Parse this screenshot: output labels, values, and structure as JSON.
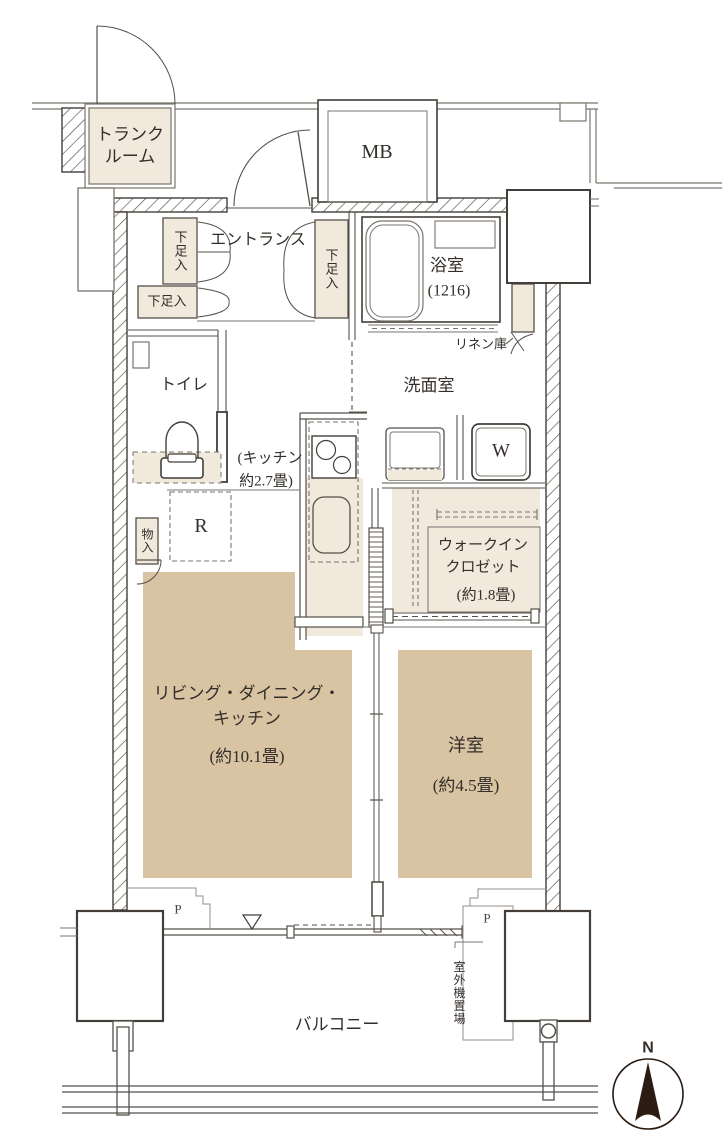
{
  "meta": {
    "width": 722,
    "height": 1140,
    "kind": "apartment-floor-plan"
  },
  "colors": {
    "room_fill_light": "#f2e9dd",
    "room_fill_tan": "#d8c3a2",
    "wall_dark": "#433e39",
    "line_mid": "#7a746e",
    "text": "#332e2a",
    "compass": "#2a1c13"
  },
  "labels": {
    "trunk_room": "トランク\nルーム",
    "meter_box": "MB",
    "entrance": "エントランス",
    "shoe_left_upper": "下足入",
    "shoe_left_lower": "下足入",
    "shoe_right": "下足入",
    "bathroom": "浴室",
    "bathroom_size": "(1216)",
    "linen": "リネン庫",
    "washroom": "洗面室",
    "washer": "W",
    "toilet": "トイレ",
    "kitchen_line1": "(キッチン",
    "kitchen_line2": "約2.7畳)",
    "fridge": "R",
    "storage": "物入",
    "wic_line1": "ウォークイン",
    "wic_line2": "クロゼット",
    "wic_size": "(約1.8畳)",
    "ldk_line1": "リビング・ダイニング・",
    "ldk_line2": "キッチン",
    "ldk_size": "(約10.1畳)",
    "western_room": "洋室",
    "western_size": "(約4.5畳)",
    "balcony": "バルコニー",
    "outdoor_unit": "室外機置場",
    "pipe_left": "P",
    "pipe_right": "P",
    "compass_north": "N"
  }
}
